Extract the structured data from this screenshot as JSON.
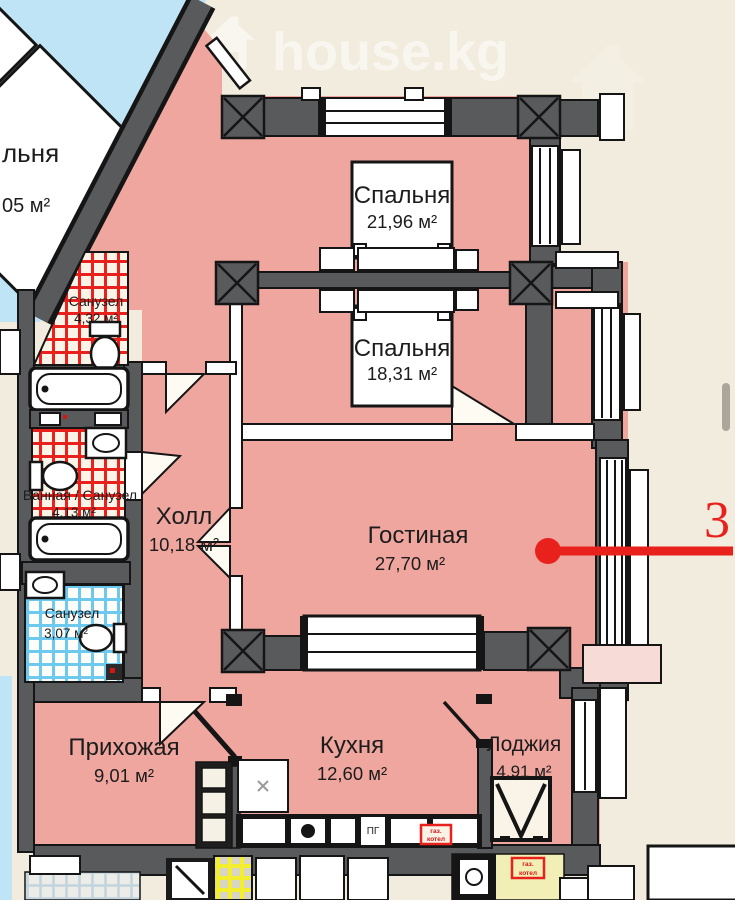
{
  "watermark": {
    "brand": "house.kg"
  },
  "selection": {
    "apartment_number": "3"
  },
  "rooms": [
    {
      "id": "bedroom-1",
      "name": "Спальня",
      "area": "21,96 м²"
    },
    {
      "id": "bedroom-2",
      "name": "Спальня",
      "area": "18,31 м²"
    },
    {
      "id": "living-room",
      "name": "Гостиная",
      "area": "27,70 м²"
    },
    {
      "id": "hall",
      "name": "Холл",
      "area": "10,18 м²"
    },
    {
      "id": "bathroom-1",
      "name": "Санузел",
      "area": "4,32 м²"
    },
    {
      "id": "bathroom-2",
      "name": "Ванная / Санузел",
      "area": "4,13 м²"
    },
    {
      "id": "bathroom-3",
      "name": "Санузел",
      "area": "3,07 м²"
    },
    {
      "id": "entry-hall",
      "name": "Прихожая",
      "area": "9,01 м²"
    },
    {
      "id": "kitchen",
      "name": "Кухня",
      "area": "12,60 м²"
    },
    {
      "id": "loggia",
      "name": "Лоджия",
      "area": "4,91 м²"
    }
  ],
  "neighbor": {
    "name_partial": "льня",
    "area_partial": "05 м²"
  },
  "equipment": {
    "gas_boiler_line1": "газ.",
    "gas_boiler_line2": "котел",
    "gas_stove": "ПГ"
  },
  "colors": {
    "background": "#f1ecdd",
    "room_fill": "#efa69e",
    "neighbor_fill": "#bfe4f5",
    "wall": "#595a5c",
    "accent_red": "#e8211d",
    "tile_red": "#e8211d",
    "tile_blue": "#6ec9ef",
    "tile_yellow": "#f3ee2f",
    "pale_yellow_room": "#f2efb6"
  }
}
